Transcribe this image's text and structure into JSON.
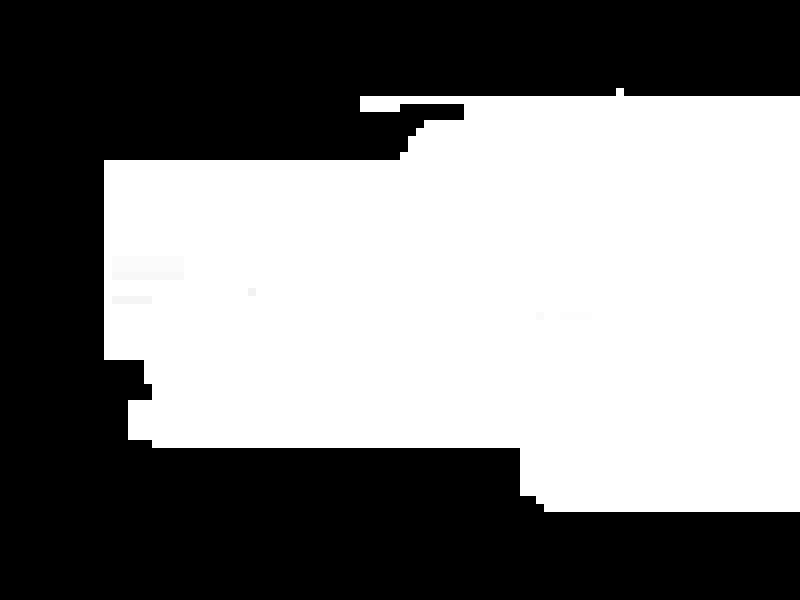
{
  "canvas": {
    "width": 800,
    "height": 600,
    "background_color": "#000000",
    "mask_color": "#ffffff"
  },
  "mask": {
    "grid_cell_px": 8,
    "white_rects": [
      {
        "x": 616,
        "y": 88,
        "w": 8,
        "h": 8
      },
      {
        "x": 360,
        "y": 96,
        "w": 440,
        "h": 8
      },
      {
        "x": 360,
        "y": 104,
        "w": 40,
        "h": 8
      },
      {
        "x": 464,
        "y": 104,
        "w": 336,
        "h": 16
      },
      {
        "x": 424,
        "y": 120,
        "w": 376,
        "h": 8
      },
      {
        "x": 416,
        "y": 128,
        "w": 384,
        "h": 8
      },
      {
        "x": 408,
        "y": 136,
        "w": 392,
        "h": 16
      },
      {
        "x": 400,
        "y": 152,
        "w": 400,
        "h": 8
      },
      {
        "x": 104,
        "y": 160,
        "w": 696,
        "h": 200
      },
      {
        "x": 144,
        "y": 360,
        "w": 656,
        "h": 24
      },
      {
        "x": 152,
        "y": 384,
        "w": 648,
        "h": 16
      },
      {
        "x": 128,
        "y": 400,
        "w": 672,
        "h": 40
      },
      {
        "x": 152,
        "y": 440,
        "w": 648,
        "h": 8
      },
      {
        "x": 520,
        "y": 448,
        "w": 280,
        "h": 48
      },
      {
        "x": 536,
        "y": 496,
        "w": 264,
        "h": 8
      },
      {
        "x": 544,
        "y": 504,
        "w": 256,
        "h": 8
      }
    ],
    "tint_rects": [
      {
        "x": 112,
        "y": 256,
        "w": 72,
        "h": 16,
        "color": "#fbfbfb"
      },
      {
        "x": 112,
        "y": 272,
        "w": 72,
        "h": 8,
        "color": "#f8f8f8"
      },
      {
        "x": 248,
        "y": 288,
        "w": 8,
        "h": 8,
        "color": "#f2f2f2"
      },
      {
        "x": 112,
        "y": 296,
        "w": 40,
        "h": 8,
        "color": "#f5f5f5"
      },
      {
        "x": 536,
        "y": 312,
        "w": 8,
        "h": 8,
        "color": "#fafafa"
      },
      {
        "x": 560,
        "y": 312,
        "w": 32,
        "h": 8,
        "color": "#fdfdfd"
      }
    ]
  }
}
